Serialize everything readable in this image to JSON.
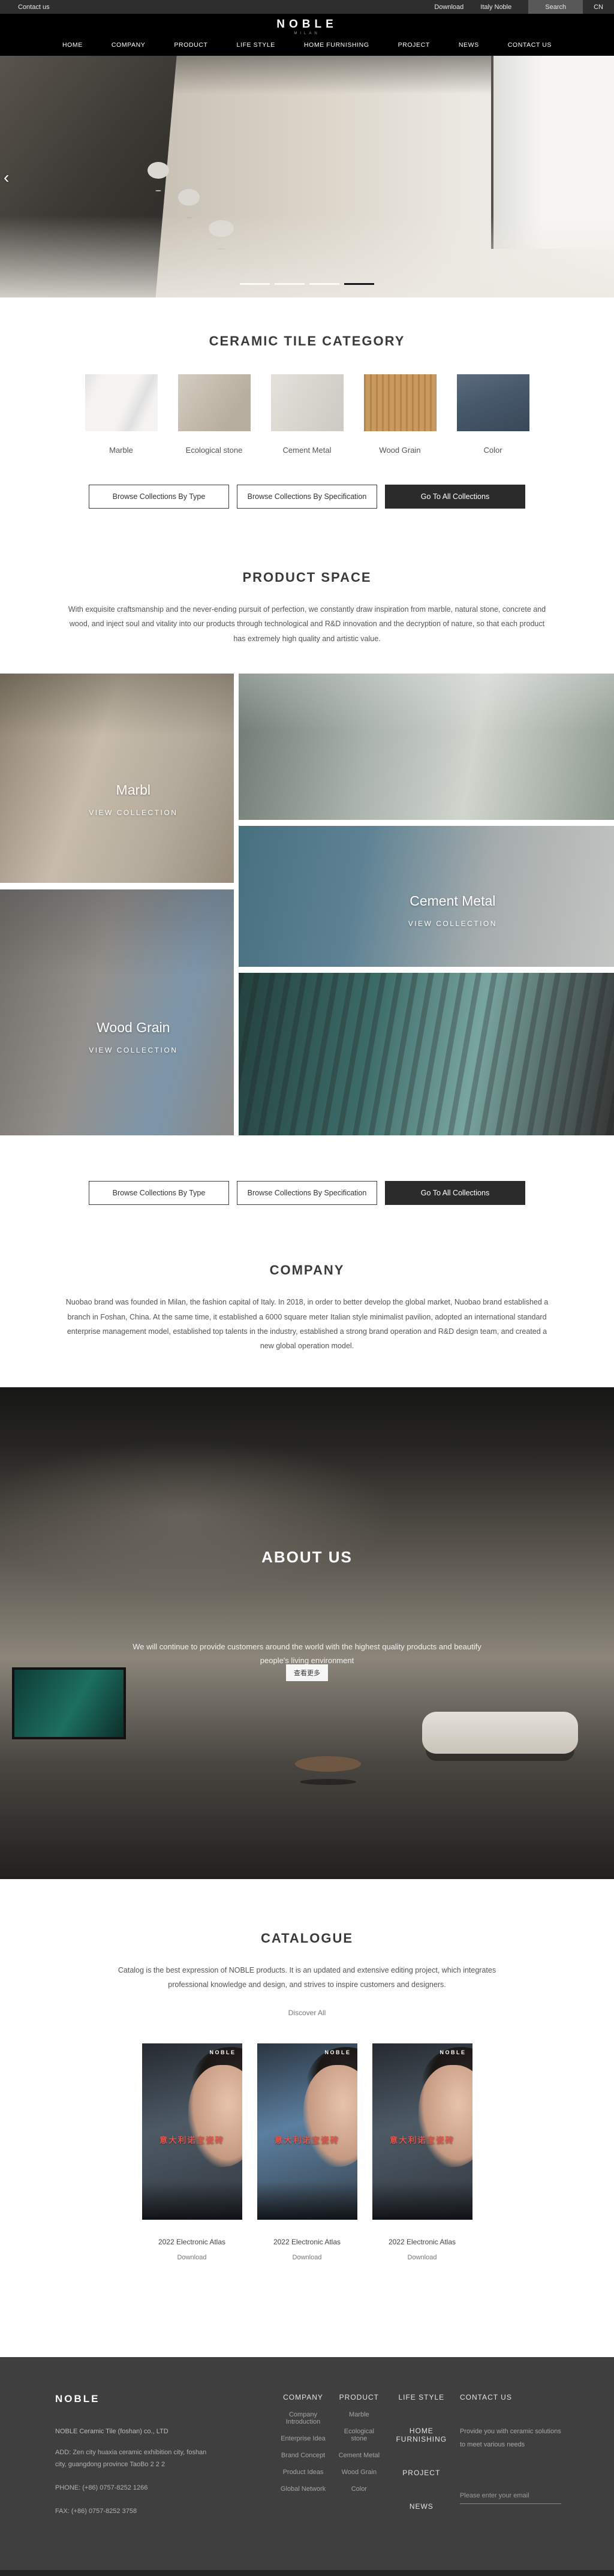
{
  "topbar": {
    "contact_us": "Contact us",
    "download": "Download",
    "italy_noble": "Italy Noble",
    "search": "Search",
    "language": "CN"
  },
  "header": {
    "logo": "NOBLE",
    "logo_sub": "MILAN",
    "nav": [
      "HOME",
      "COMPANY",
      "PRODUCT",
      "LIFE STYLE",
      "HOME FURNISHING",
      "PROJECT",
      "NEWS",
      "CONTACT US"
    ],
    "prev_arrow": "‹"
  },
  "category": {
    "title": "CERAMIC TILE CATEGORY",
    "tiles": [
      {
        "label": "Marble",
        "color": "#f4f3f1"
      },
      {
        "label": "Ecological stone",
        "color": "#c6bcae"
      },
      {
        "label": "Cement Metal",
        "color": "#d8d5ce"
      },
      {
        "label": "Wood Grain",
        "color": "#c89a5f"
      },
      {
        "label": "Color",
        "color": "#46586b"
      }
    ],
    "buttons": {
      "by_type": "Browse Collections By Type",
      "by_spec": "Browse Collections By Specification",
      "all": "Go To All Collections"
    }
  },
  "product_space": {
    "title": "PRODUCT SPACE",
    "description": "With exquisite craftsmanship and the never-ending pursuit of perfection, we constantly draw inspiration from marble, natural stone, concrete and wood, and inject soul and vitality into our products through technological and R&D innovation and the decryption of nature, so that each product has extremely high quality and artistic value."
  },
  "collections": {
    "items": [
      {
        "name": "Marbl",
        "cta": "VIEW COLLECTION"
      },
      {
        "name": "Cement Metal",
        "cta": "VIEW COLLECTION"
      },
      {
        "name": "Wood Grain",
        "cta": "VIEW COLLECTION"
      }
    ]
  },
  "company": {
    "title": "COMPANY",
    "description": "Nuobao brand was founded in Milan, the fashion capital of Italy. In 2018, in order to better develop the global market, Nuobao brand established a branch in Foshan, China. At the same time, it established a 6000 square meter Italian style minimalist pavilion, adopted an international standard enterprise management model, established top talents in the industry, established a strong brand operation and R&D design team, and created a new global operation model."
  },
  "about": {
    "title": "ABOUT US",
    "description": "We will continue to provide customers around the world with the highest quality products and beautify people's living environment",
    "more_button": "查看更多"
  },
  "catalogue": {
    "title": "CATALOGUE",
    "description": "Catalog is the best expression of NOBLE products. It is an updated and extensive editing project, which integrates professional knowledge and design, and strives to inspire customers and designers.",
    "discover_all": "Discover All",
    "cover_brand": "NOBLE",
    "cover_title": "意大利诺宝瓷砖",
    "items": [
      {
        "title": "2022 Electronic Atlas",
        "download": "Download"
      },
      {
        "title": "2022 Electronic Atlas",
        "download": "Download"
      },
      {
        "title": "2022 Electronic Atlas",
        "download": "Download"
      }
    ]
  },
  "footer": {
    "brand": "NOBLE",
    "company_name": "NOBLE Ceramic Tile (foshan) co., LTD",
    "address": "ADD:  Zen city huaxia ceramic exhibition city, foshan city, guangdong province TaoBo 2 2 2",
    "phone": "PHONE:   (+86)  0757-8252 1266",
    "fax": "FAX:   (+86)  0757-8252 3758",
    "columns": {
      "company": {
        "title": "COMPANY",
        "links": [
          "Company Introduction",
          "Enterprise Idea",
          "Brand Concept",
          "Product Ideas",
          "Global Network"
        ]
      },
      "product": {
        "title": "PRODUCT",
        "links": [
          "Marble",
          "Ecological stone",
          "Cement Metal",
          "Wood Grain",
          "Color"
        ]
      },
      "nav": {
        "links": [
          "LIFE STYLE",
          "HOME FURNISHING",
          "PROJECT",
          "NEWS"
        ]
      },
      "contact": {
        "title": "CONTACT US",
        "text": "Provide you with ceramic solutions to meet various needs",
        "email_placeholder": "Please enter your email"
      }
    }
  }
}
